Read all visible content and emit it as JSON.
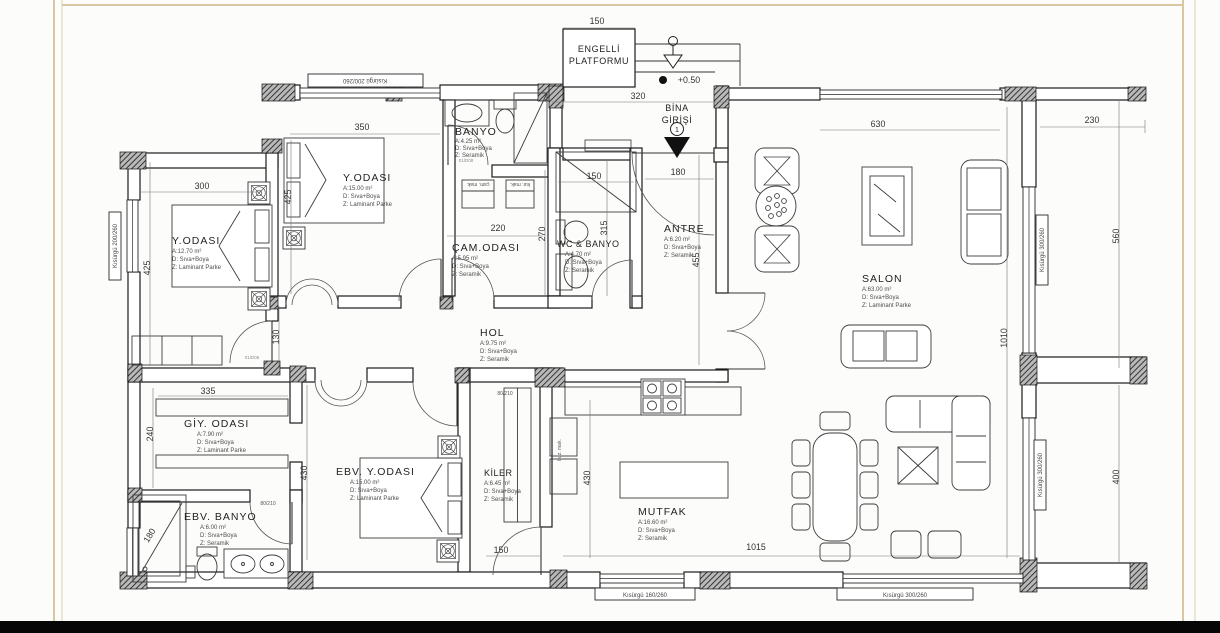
{
  "canvas": {
    "background": "#fcfcfa",
    "frame_line": "#d9c6a2",
    "wall_line": "#1b1b1b",
    "bottom_bar": "#060606"
  },
  "entrance": {
    "platform_line1": "ENGELLİ",
    "platform_line2": "PLATFORMU",
    "level": "+0.50",
    "name_line1": "BİNA",
    "name_line2": "GİRİŞİ",
    "door_number": "1"
  },
  "rooms": {
    "y_odasi_1": {
      "name": "Y.ODASI",
      "area": "A:12.70 m²",
      "wall": "D: Sıva+Boya",
      "floor": "Z: Laminant Parke"
    },
    "y_odasi_2": {
      "name": "Y.ODASI",
      "area": "A:15.00 m²",
      "wall": "D: Sıva+Boya",
      "floor": "Z: Laminant Parke"
    },
    "banyo": {
      "name": "BANYO",
      "area": "A:4.25 m²",
      "wall": "D: Sıva+Boya",
      "floor": "Z: Seramik"
    },
    "cam_odasi": {
      "name": "ÇAM.ODASI",
      "area": "A:5.95 m²",
      "wall": "D: Sıva+Boya",
      "floor": "Z: Seramik"
    },
    "wc_banyo": {
      "name": "WC & BANYO",
      "area": "A:4.70 m²",
      "wall": "D: Sıva+Boya",
      "floor": "Z: Seramik"
    },
    "antre": {
      "name": "ANTRE",
      "area": "A:6.20 m²",
      "wall": "D: Sıva+Boya",
      "floor": "Z: Seramik"
    },
    "salon": {
      "name": "SALON",
      "area": "A:63.00 m²",
      "wall": "D: Sıva+Boya",
      "floor": "Z: Laminant Parke"
    },
    "hol": {
      "name": "HOL",
      "area": "A:9.75 m²",
      "wall": "D: Sıva+Boya",
      "floor": "Z: Seramik"
    },
    "giy_odasi": {
      "name": "GİY. ODASI",
      "area": "A:7.90 m²",
      "wall": "D: Sıva+Boya",
      "floor": "Z: Laminant Parke"
    },
    "ebv_y_odasi": {
      "name": "EBV. Y.ODASI",
      "area": "A:15.00 m²",
      "wall": "D: Sıva+Boya",
      "floor": "Z: Laminant Parke"
    },
    "kiler": {
      "name": "KİLER",
      "area": "A:6.45 m²",
      "wall": "D: Sıva+Boya",
      "floor": "Z: Seramik"
    },
    "mutfak": {
      "name": "MUTFAK",
      "area": "A:16.60 m²",
      "wall": "D: Sıva+Boya",
      "floor": "Z: Seramik"
    },
    "ebv_banyo": {
      "name": "EBV. BANYO",
      "area": "A:6.00 m²",
      "wall": "D: Sıva+Boya",
      "floor": "Z: Seramik"
    }
  },
  "dims": {
    "platform_w": "150",
    "entry_w": "320",
    "salon_window_w": "630",
    "terrace_top_w": "230",
    "right_upper_h": "560",
    "salon_h": "1010",
    "right_lower_h": "400",
    "yodasi2_w": "350",
    "yodasi1_w": "300",
    "yodasi1_h": "425",
    "yodasi2_h": "425",
    "cam_w": "220",
    "cam_h": "270",
    "wc_shower_w": "150",
    "wc_h": "315",
    "antre_w": "180",
    "antre_h": "455",
    "yodasi1_door": "130",
    "giy_w": "335",
    "giy_h": "240",
    "ebv_h": "430",
    "mutfak_h": "430",
    "ebv_shower": "180",
    "kiler_door": "150",
    "mutfak_w": "1015"
  },
  "windows": {
    "top_bedroom": "Kısürgü 200/260",
    "left_bedroom": "Kısürgü 200/260",
    "salon_upper": "Kısürgü 300/260",
    "salon_lower": "Kısürgü 300/260",
    "bottom_left": "Kısürgü 160/260",
    "bottom_right": "Kısürgü 300/260"
  },
  "appliances": {
    "washer": "çam. mak.",
    "dryer": "kur. mak.",
    "fridge": "buz. mak."
  },
  "door_tags": {
    "kiler": "80/210",
    "ebv_banyo": "80/210"
  },
  "door_codes": {
    "hol": "01/D06",
    "banyo": "01/D08"
  }
}
